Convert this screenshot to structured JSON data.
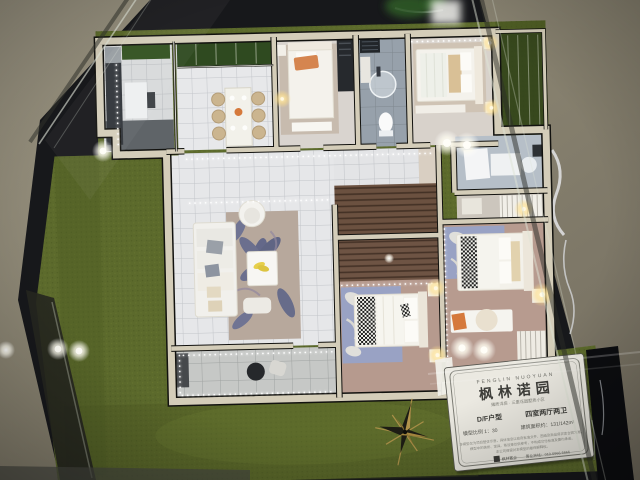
{
  "plaque": {
    "brand_en": "FENGLIN NUOYUAN",
    "brand_cn": "枫林诺园",
    "subtitle": "臻质洋房 · 三重花园墅质小区",
    "unit_type": "D/F户型",
    "unit_layout": "四室两厅两卫",
    "scale_label": "模型比例 1：30",
    "area_label": "建筑面积约：131/142m²",
    "disclaimer_lines": [
      "本模型仅为项目整体示意，具体信息以政府批准文件、图纸及商品房买卖合同为准。",
      "模型中的装修、家具、陈设等仅供参考，不构成交付标准及要约承诺。",
      "本公司保留对本模型的最终解释权。"
    ],
    "logo_text": "枫林置业",
    "hotline": "置业热线：010-6966 6666"
  },
  "colors": {
    "felt_green": "#5c6a2c",
    "marble_black": "#17181b",
    "wall_cream": "#d4cdb9",
    "floor_grey": "#8b8577",
    "rug_blue": "#99a2c4",
    "lamp_gold": "#ffdf8a",
    "accent_orange": "#d5793c"
  }
}
